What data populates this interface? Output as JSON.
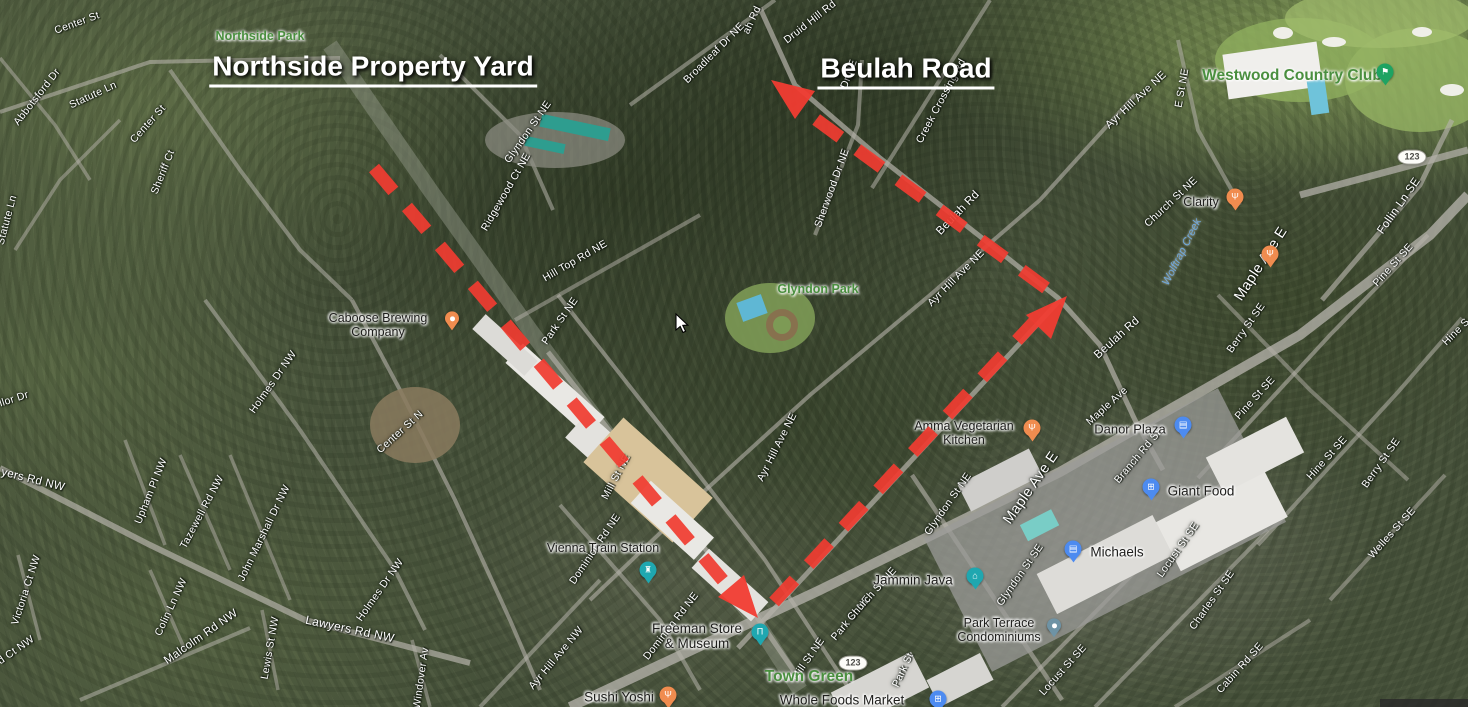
{
  "headlines": [
    {
      "text": "Northside Property Yard",
      "x": 373,
      "y": 69
    },
    {
      "text": "Beulah Road",
      "x": 906,
      "y": 71
    }
  ],
  "map": {
    "street_labels": [
      {
        "text": "Center St",
        "x": 77,
        "y": 23,
        "rot": -20
      },
      {
        "text": "Abbotsford Dr",
        "x": 37,
        "y": 97,
        "rot": -52
      },
      {
        "text": "Statute Ln",
        "x": 93,
        "y": 95,
        "rot": -25
      },
      {
        "text": "Center St",
        "x": 148,
        "y": 124,
        "rot": -48
      },
      {
        "text": "Sheriff Ct",
        "x": 163,
        "y": 172,
        "rot": -68
      },
      {
        "text": "Statute Ln",
        "x": 7,
        "y": 220,
        "rot": -75
      },
      {
        "text": "llor Dr",
        "x": 14,
        "y": 399,
        "rot": -18
      },
      {
        "text": "Center St N",
        "x": 400,
        "y": 432,
        "rot": -42
      },
      {
        "text": "Holmes Dr NW",
        "x": 273,
        "y": 382,
        "rot": -55
      },
      {
        "text": "Upham Pl NW",
        "x": 151,
        "y": 491,
        "rot": -68
      },
      {
        "text": "Tazewell Rd NW",
        "x": 202,
        "y": 512,
        "rot": -62
      },
      {
        "text": "John Marshall Dr NW",
        "x": 264,
        "y": 533,
        "rot": -64
      },
      {
        "text": "yers Rd NW",
        "x": 33,
        "y": 480,
        "rot": 14,
        "fs": 11.5
      },
      {
        "text": "Victoria Ct NW",
        "x": 26,
        "y": 590,
        "rot": -72
      },
      {
        "text": "d Ct NW",
        "x": 16,
        "y": 650,
        "rot": -35
      },
      {
        "text": "Colin Ln NW",
        "x": 171,
        "y": 607,
        "rot": -65
      },
      {
        "text": "Malcolm Rd NW",
        "x": 201,
        "y": 637,
        "rot": -35,
        "fs": 11.5
      },
      {
        "text": "Lewis St NW",
        "x": 270,
        "y": 648,
        "rot": -80
      },
      {
        "text": "Lawyers Rd NW",
        "x": 350,
        "y": 629,
        "rot": 12,
        "fs": 12
      },
      {
        "text": "Holmes Dr NW",
        "x": 380,
        "y": 590,
        "rot": -55
      },
      {
        "text": "Windover Av",
        "x": 421,
        "y": 678,
        "rot": -82
      },
      {
        "text": "Glyndon St NE",
        "x": 528,
        "y": 132,
        "rot": -55
      },
      {
        "text": "Ridgewood Ct NE",
        "x": 506,
        "y": 192,
        "rot": -60
      },
      {
        "text": "Hill Top Rd NE",
        "x": 575,
        "y": 261,
        "rot": -30
      },
      {
        "text": "Park St NE",
        "x": 560,
        "y": 321,
        "rot": -55
      },
      {
        "text": "Mill St NE",
        "x": 616,
        "y": 477,
        "rot": -62
      },
      {
        "text": "Broadleaf Dr NE",
        "x": 714,
        "y": 53,
        "rot": -45
      },
      {
        "text": "ah Rd",
        "x": 752,
        "y": 20,
        "rot": -65
      },
      {
        "text": "Druid Hill Rd",
        "x": 810,
        "y": 22,
        "rot": -38
      },
      {
        "text": "Dr NE",
        "x": 849,
        "y": 74,
        "rot": -70
      },
      {
        "text": "Creek Crossing Rd",
        "x": 941,
        "y": 101,
        "rot": -62
      },
      {
        "text": "Sherwood Dr NE",
        "x": 832,
        "y": 188,
        "rot": -70
      },
      {
        "text": "Beulah Rd",
        "x": 958,
        "y": 213,
        "rot": -46,
        "fs": 11.5
      },
      {
        "text": "Ayr Hill Ave NE",
        "x": 1136,
        "y": 100,
        "rot": -43,
        "fs": 11
      },
      {
        "text": "E St NE",
        "x": 1182,
        "y": 88,
        "rot": -80
      },
      {
        "text": "Church St NE",
        "x": 1171,
        "y": 202,
        "rot": -43
      },
      {
        "text": "Follin Ln SE",
        "x": 1399,
        "y": 206,
        "rot": -55,
        "fs": 11.5
      },
      {
        "text": "Ayr Hill Ave NE",
        "x": 956,
        "y": 278,
        "rot": -45
      },
      {
        "text": "Ayr Hill Ave NE",
        "x": 777,
        "y": 447,
        "rot": -63
      },
      {
        "text": "Beulah Rd",
        "x": 1117,
        "y": 338,
        "rot": -42,
        "fs": 11.5
      },
      {
        "text": "Maple Ave E",
        "x": 1261,
        "y": 264,
        "rot": -57,
        "fs": 14.5
      },
      {
        "text": "Pine St SE",
        "x": 1393,
        "y": 265,
        "rot": -48
      },
      {
        "text": "Berry St SE",
        "x": 1246,
        "y": 328,
        "rot": -55
      },
      {
        "text": "Pine St SE",
        "x": 1255,
        "y": 398,
        "rot": -48
      },
      {
        "text": "Hine S",
        "x": 1456,
        "y": 332,
        "rot": -45
      },
      {
        "text": "Hine St SE",
        "x": 1327,
        "y": 458,
        "rot": -48
      },
      {
        "text": "Berry St SE",
        "x": 1381,
        "y": 463,
        "rot": -55
      },
      {
        "text": "Welles St SE",
        "x": 1392,
        "y": 533,
        "rot": -48
      },
      {
        "text": "Branch Rd SE",
        "x": 1139,
        "y": 455,
        "rot": -50
      },
      {
        "text": "Maple Ave E",
        "x": 1031,
        "y": 488,
        "rot": -55,
        "fs": 14.5
      },
      {
        "text": "Maple Ave",
        "x": 1107,
        "y": 406,
        "rot": -42
      },
      {
        "text": "Glyndon St NE",
        "x": 948,
        "y": 504,
        "rot": -55
      },
      {
        "text": "Glyndon St SE",
        "x": 1020,
        "y": 575,
        "rot": -55
      },
      {
        "text": "Locust St SE",
        "x": 1178,
        "y": 550,
        "rot": -55
      },
      {
        "text": "Locust St SE",
        "x": 1063,
        "y": 670,
        "rot": -48
      },
      {
        "text": "Charles St SE",
        "x": 1212,
        "y": 600,
        "rot": -55
      },
      {
        "text": "Cabin Rd SE",
        "x": 1240,
        "y": 668,
        "rot": -48
      },
      {
        "text": "Park St NE",
        "x": 851,
        "y": 618,
        "rot": -50
      },
      {
        "text": "Park St",
        "x": 903,
        "y": 670,
        "rot": -65
      },
      {
        "text": "Mill St NE",
        "x": 808,
        "y": 659,
        "rot": -55
      },
      {
        "text": "Church St NE",
        "x": 872,
        "y": 594,
        "rot": -48
      },
      {
        "text": "Dominion Rd NE",
        "x": 595,
        "y": 549,
        "rot": -56
      },
      {
        "text": "Dominion Rd NE",
        "x": 671,
        "y": 626,
        "rot": -52
      },
      {
        "text": "Ayr Hill Ave NW",
        "x": 556,
        "y": 658,
        "rot": -50
      }
    ],
    "park_labels": [
      {
        "text": "Northside Park",
        "x": 260,
        "y": 36,
        "fs": 12.5
      },
      {
        "text": "Glyndon Park",
        "x": 818,
        "y": 289,
        "fs": 12.5
      },
      {
        "text": "Town Green",
        "x": 809,
        "y": 677,
        "fs": 15.5
      },
      {
        "text": "Westwood Country Club",
        "x": 1292,
        "y": 76,
        "fs": 15.5
      }
    ],
    "water_labels": [
      {
        "text": "Wolftrap Creek",
        "x": 1182,
        "y": 252,
        "rot": -63,
        "fs": 11
      }
    ],
    "poi_labels": [
      {
        "lines": [
          "Caboose Brewing",
          "Company"
        ],
        "x": 378,
        "y": 325,
        "fs": 12.5,
        "pin": {
          "type": "brewery-dot",
          "color": "#F08C4F",
          "x": 452,
          "y": 320
        }
      },
      {
        "lines": [
          "Vienna Train Station"
        ],
        "x": 603,
        "y": 548,
        "fs": 12.5,
        "pin": {
          "type": "train-station",
          "color": "#1FA7B0",
          "x": 648,
          "y": 572
        }
      },
      {
        "lines": [
          "Freeman Store",
          "& Museum"
        ],
        "x": 697,
        "y": 636,
        "fs": 13.5,
        "pin": {
          "type": "museum",
          "color": "#1FA7B0",
          "x": 760,
          "y": 634
        }
      },
      {
        "lines": [
          "Sushi Yoshi"
        ],
        "x": 619,
        "y": 697,
        "fs": 13.5,
        "pin": {
          "type": "restaurant",
          "color": "#F08C4F",
          "x": 668,
          "y": 697
        }
      },
      {
        "lines": [
          "Whole Foods Market"
        ],
        "x": 842,
        "y": 700,
        "fs": 13.5,
        "pin": {
          "type": "grocery-cart",
          "color": "#4D8BF0",
          "x": 938,
          "y": 701
        }
      },
      {
        "lines": [
          "Jammin Java"
        ],
        "x": 913,
        "y": 580,
        "fs": 13.5,
        "pin": {
          "type": "storefront",
          "color": "#1FA7B0",
          "x": 975,
          "y": 578
        }
      },
      {
        "lines": [
          "Park Terrace",
          "Condominiums"
        ],
        "x": 999,
        "y": 630,
        "fs": 12.5,
        "pin": {
          "type": "condo-dot",
          "color": "#6E93A5",
          "x": 1054,
          "y": 627
        }
      },
      {
        "lines": [
          "Amma Vegetarian",
          "Kitchen"
        ],
        "x": 964,
        "y": 433,
        "fs": 12.5,
        "pin": {
          "type": "restaurant",
          "color": "#F08C4F",
          "x": 1032,
          "y": 430
        }
      },
      {
        "lines": [
          "Danor Plaza"
        ],
        "x": 1130,
        "y": 430,
        "fs": 13,
        "pin": {
          "type": "shopping-bag",
          "color": "#4D8BF0",
          "x": 1183,
          "y": 427
        }
      },
      {
        "lines": [
          "Giant Food"
        ],
        "x": 1201,
        "y": 491,
        "fs": 13.5,
        "pin": {
          "type": "grocery-cart",
          "color": "#4D8BF0",
          "x": 1151,
          "y": 489
        }
      },
      {
        "lines": [
          "Michaels"
        ],
        "x": 1117,
        "y": 552,
        "fs": 13.5,
        "pin": {
          "type": "shopping-bag",
          "color": "#4D8BF0",
          "x": 1073,
          "y": 551
        }
      },
      {
        "lines": [
          "Clarity"
        ],
        "x": 1201,
        "y": 202,
        "fs": 12.5,
        "pin": {
          "type": "restaurant",
          "color": "#F08C4F",
          "x": 1235,
          "y": 199
        }
      }
    ],
    "extra_pins": [
      {
        "type": "restaurant",
        "color": "#F08C4F",
        "x": 1270,
        "y": 256
      },
      {
        "type": "golf",
        "color": "#1EA362",
        "x": 1385,
        "y": 74
      }
    ],
    "route_badges": [
      {
        "text": "123",
        "x": 853,
        "y": 663
      },
      {
        "text": "123",
        "x": 1412,
        "y": 157
      }
    ]
  },
  "route": {
    "color": "#f13c31",
    "dash_length": 30,
    "gap_length": 21,
    "stroke_width": 13,
    "segments": [
      {
        "x1": 374,
        "y1": 168,
        "x2": 726,
        "y2": 584
      },
      {
        "x1": 774,
        "y1": 602,
        "x2": 1034,
        "y2": 322
      },
      {
        "x1": 1046,
        "y1": 288,
        "x2": 806,
        "y2": 112
      }
    ],
    "arrowheads": [
      {
        "points": "758,618 744,575 718,597"
      },
      {
        "points": "1067,296 1051,339 1026,315"
      },
      {
        "points": "771,80 815,91 795,119"
      }
    ]
  },
  "cursor": {
    "x": 675,
    "y": 313
  }
}
